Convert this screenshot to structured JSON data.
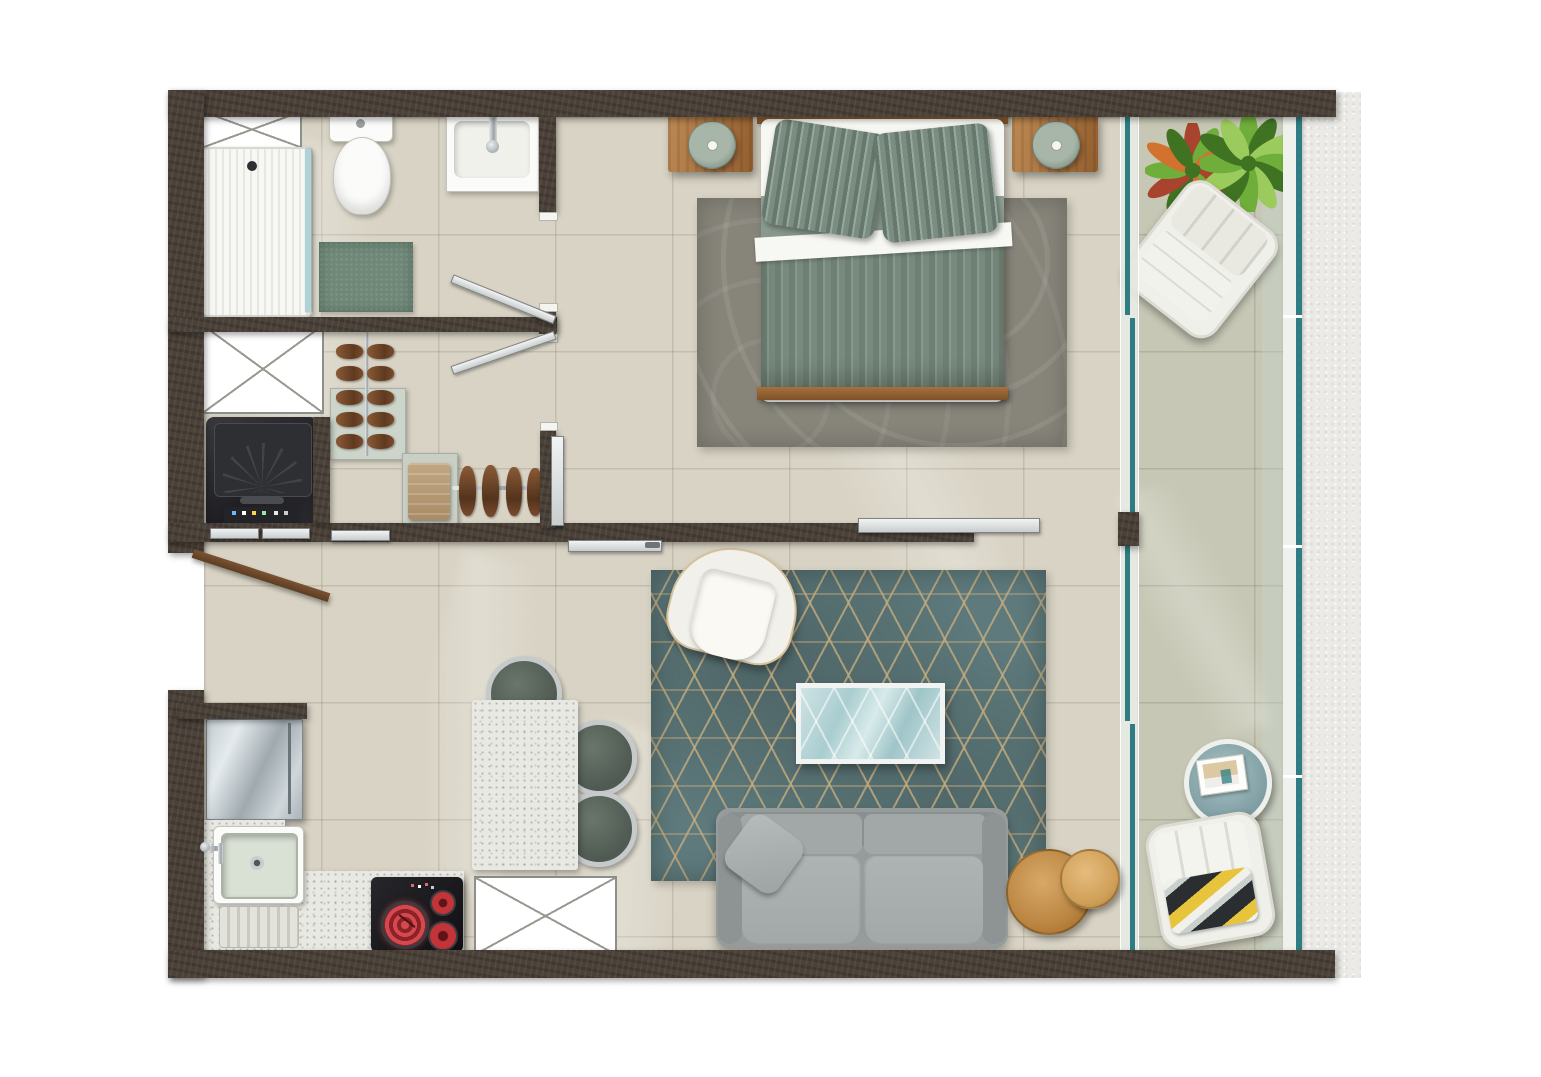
{
  "meta": {
    "type": "apartment-floor-plan",
    "view": "top-down-render",
    "visible_text": "none"
  },
  "palette": {
    "wall": "#4a4138",
    "floor": "#d8d3c4",
    "balconyFloor": "#c7c7b5",
    "exterior": "#ebeae6",
    "teal": "#2e7d82",
    "rugTeal": "#5e7a7c",
    "rugGold": "#c4ab7e",
    "bedroomRug": "#87857a",
    "wood": "#b07c48",
    "woodDark": "#8d5c2e",
    "woodLight": "#d8a868",
    "sofaGray": "#969c9c",
    "cushionGray": "#a9afaf",
    "duvetGreen": "#78897d",
    "duvetStripeDark": "#66786d",
    "duvetStripeLight": "#96a89b",
    "bandGreen": "#8c9c90",
    "sheetWhite": "#f7f7f4",
    "fixtureWhite": "#fbfbf9",
    "chrome": "#c3c7c9",
    "matGreen": "#6f8878",
    "towelTan": "#b59a78",
    "shoeBrown": "#7a4a2c",
    "steel": "#b7c0c4",
    "cooktopBlack": "#1b1b1f",
    "burnerRed": "#c23438",
    "chairSage": "#5a655c",
    "entryDoorBrown": "#6b4328",
    "plantGreen": "#6fae3a",
    "plantDarkGreen": "#3f7322",
    "plantLightGreen": "#9ccb5d",
    "crotonRed": "#a8442d",
    "crotonOrange": "#d2722f",
    "towelYellow": "#e8c33c",
    "towelBlack": "#2b2e31"
  },
  "rooms": [
    {
      "name": "bathroom",
      "items": [
        "shower-tray",
        "shower-glass",
        "toilet",
        "vanity-sink",
        "bath-mat",
        "shaft-box"
      ]
    },
    {
      "name": "laundry-nook",
      "items": [
        "washing-machine",
        "storage-box",
        "sliding-doors"
      ]
    },
    {
      "name": "walk-in-closet",
      "items": [
        "shoe-rack",
        "shelf-tower",
        "towel-stack",
        "hanging-rail",
        "hanging-shoes",
        "closet-sliding-door"
      ]
    },
    {
      "name": "entry",
      "items": [
        "entry-door"
      ]
    },
    {
      "name": "kitchen",
      "items": [
        "refrigerator",
        "l-counter",
        "sink",
        "drainboard",
        "cooktop",
        "cabinet-box"
      ]
    },
    {
      "name": "dining-area",
      "items": [
        "dining-table",
        "dining-chair",
        "dining-chair",
        "dining-chair"
      ]
    },
    {
      "name": "living-area",
      "items": [
        "area-rug",
        "armchair",
        "coffee-table",
        "sofa",
        "throw-pillow",
        "nesting-side-tables",
        "hall-sliding-door"
      ]
    },
    {
      "name": "bedroom",
      "items": [
        "double-bed",
        "headboard",
        "pillows",
        "duvet",
        "footboard",
        "nightstand",
        "nightstand",
        "table-lamp",
        "table-lamp",
        "bedroom-rug",
        "bedroom-sliding-door"
      ]
    },
    {
      "name": "balcony",
      "items": [
        "potted-plant",
        "potted-plant",
        "lounge-chair",
        "round-side-table",
        "magazine",
        "outdoor-chair",
        "striped-towel",
        "glass-partition",
        "glass-balustrade"
      ]
    }
  ],
  "counts": {
    "dining_chairs": 3,
    "cooktop_burners": 3,
    "bed_pillows": 2,
    "sofa_seats": 2,
    "potted_plants": 2,
    "shoe_rows_on_rack": 5,
    "hanging_shoes": 4
  }
}
